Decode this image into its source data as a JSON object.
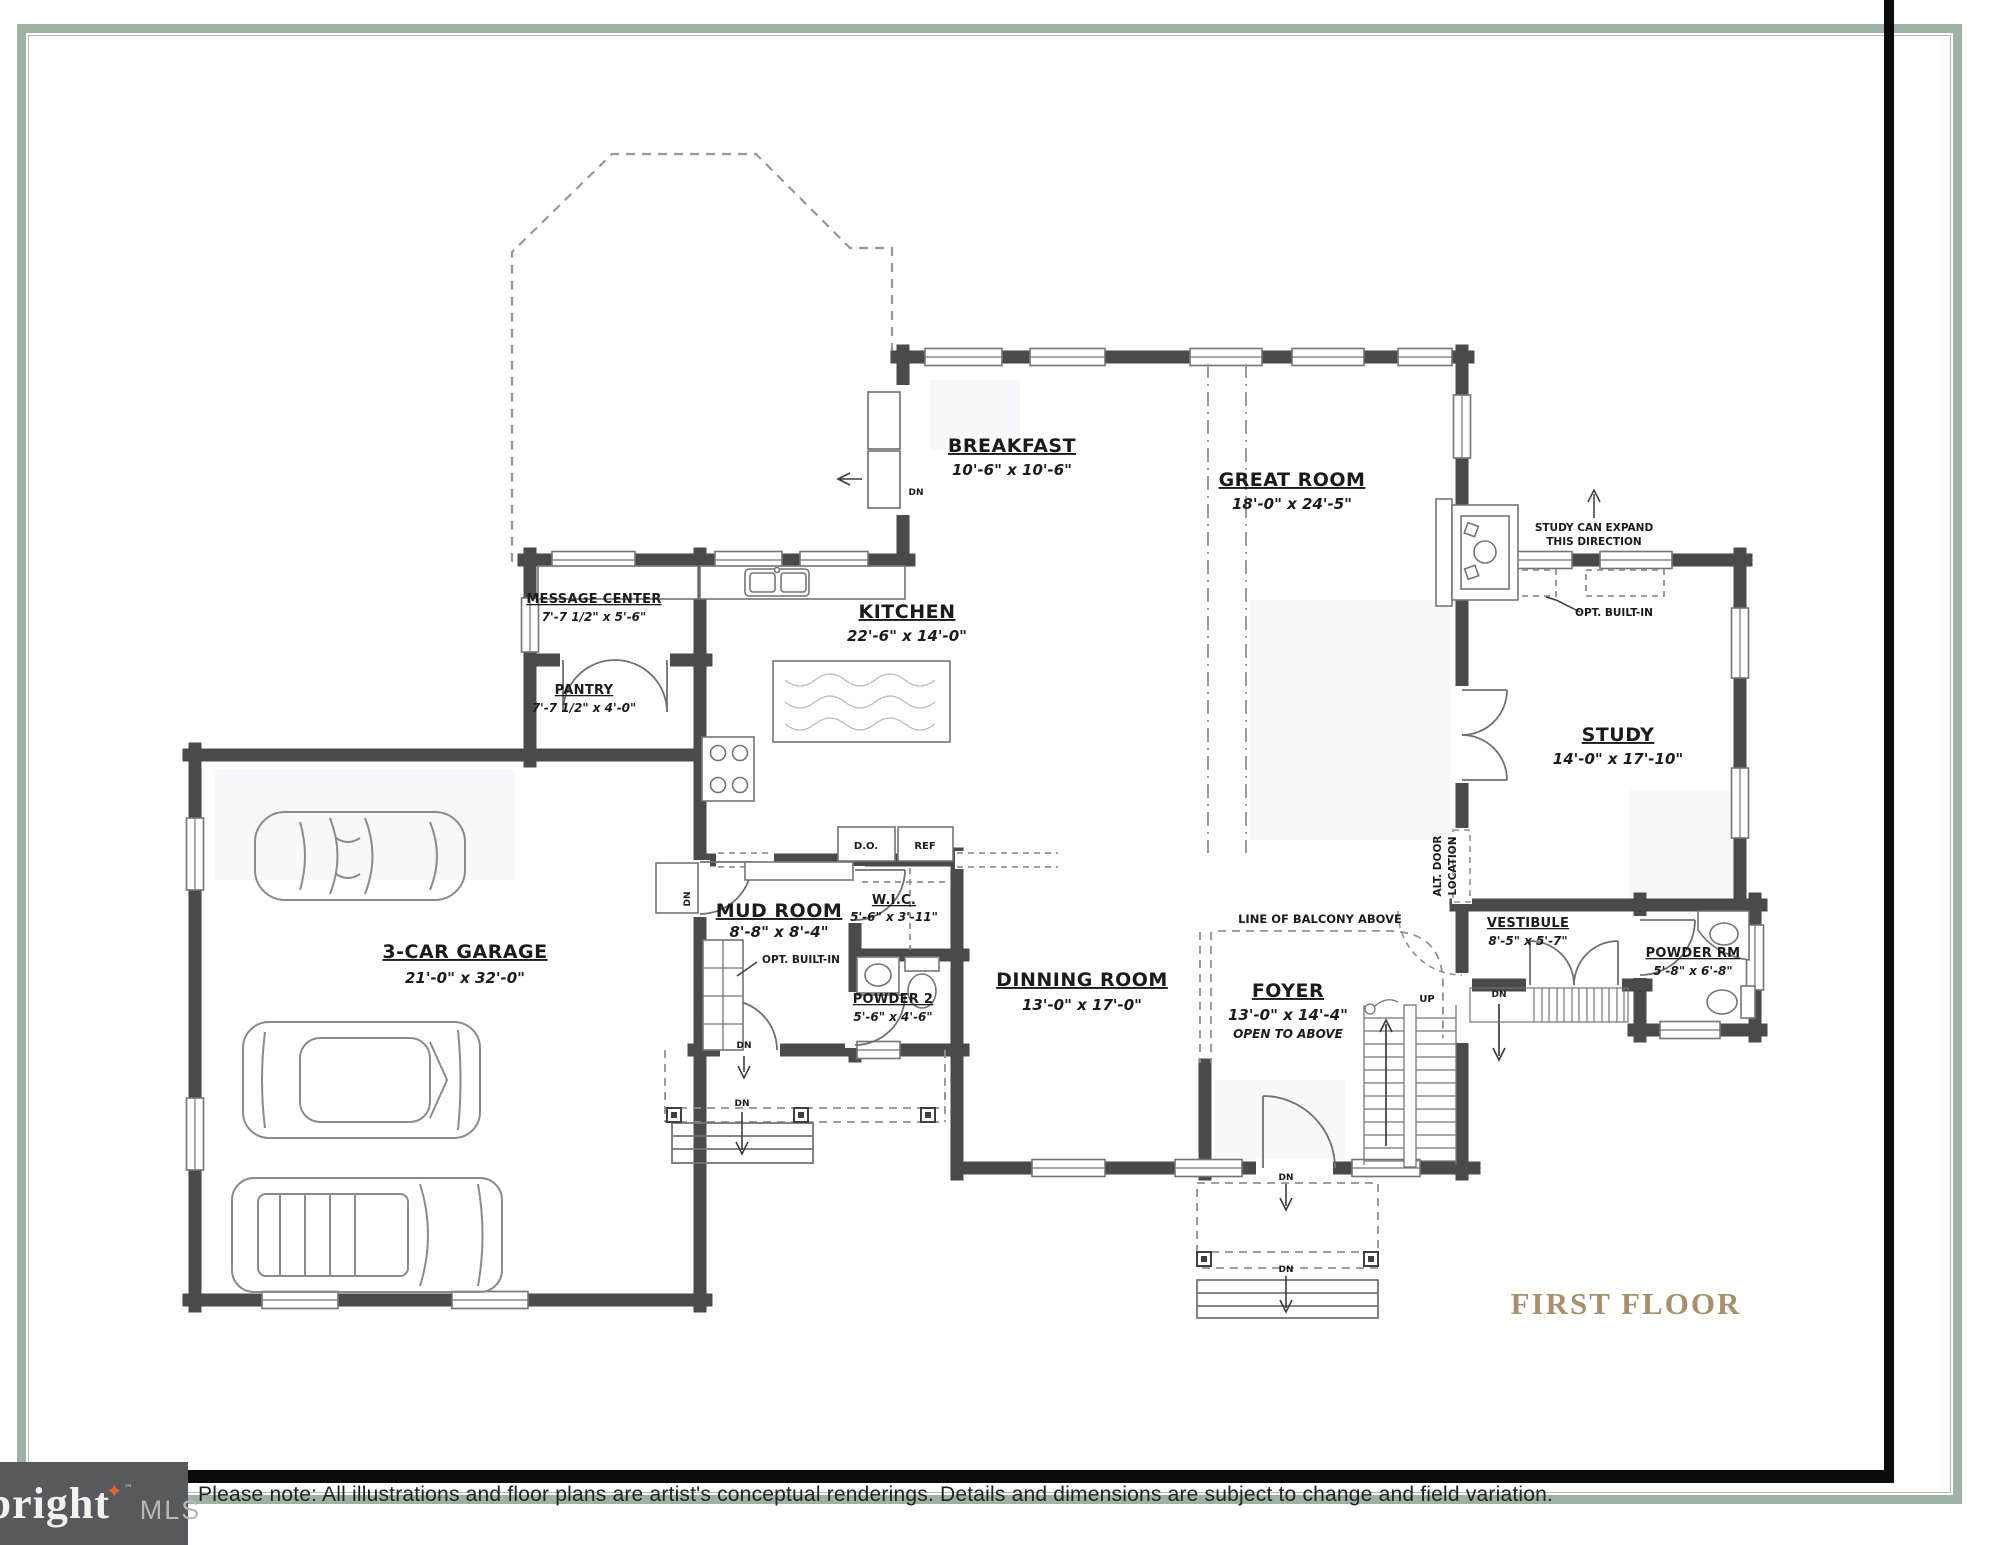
{
  "page": {
    "title": "FIRST FLOOR"
  },
  "palette": {
    "frame_green": "#9fb1a3",
    "frame_black": "#0b0b0b",
    "title_gold": "#a8906f",
    "wall_color": "#494a4c",
    "logo_bg": "#58595c",
    "logo_star_orange": "#e0653c",
    "logo_text": "#f2f1ef",
    "logo_mls_gray": "#b5b7ba"
  },
  "footer": {
    "disclaimer": "Please note: All illustrations and floor plans are artist's conceptual renderings. Details and dimensions are subject to change and field variation.",
    "logo": {
      "brand": "bright",
      "star": "✦",
      "tm": "™",
      "suffix": "MLS"
    }
  },
  "plan": {
    "rooms": [
      {
        "id": "breakfast",
        "name": "BREAKFAST",
        "dims": "10'-6\" x 10'-6\""
      },
      {
        "id": "great-room",
        "name": "GREAT ROOM",
        "dims": "18'-0\" x 24'-5\""
      },
      {
        "id": "kitchen",
        "name": "KITCHEN",
        "dims": "22'-6\" x 14'-0\""
      },
      {
        "id": "message-center",
        "name": "MESSAGE CENTER",
        "dims": "7'-7 1/2\" x 5'-6\""
      },
      {
        "id": "pantry",
        "name": "PANTRY",
        "dims": "7'-7 1/2\" x 4'-0\""
      },
      {
        "id": "garage",
        "name": "3-CAR GARAGE",
        "dims": "21'-0\" x 32'-0\""
      },
      {
        "id": "mud-room",
        "name": "MUD ROOM",
        "dims": "8'-8\" x 8'-4\""
      },
      {
        "id": "wic",
        "name": "W.I.C.",
        "dims": "5'-6\" x 3'-11\""
      },
      {
        "id": "powder-2",
        "name": "POWDER 2",
        "dims": "5'-6\" x 4'-6\""
      },
      {
        "id": "dining-room",
        "name": "DINNING ROOM",
        "dims": "13'-0\" x 17'-0\""
      },
      {
        "id": "foyer",
        "name": "FOYER",
        "dims": "13'-0\" x 14'-4\"",
        "note": "OPEN TO ABOVE"
      },
      {
        "id": "study",
        "name": "STUDY",
        "dims": "14'-0\" x 17'-10\""
      },
      {
        "id": "vestibule",
        "name": "VESTIBULE",
        "dims": "8'-5\" x 5'-7\""
      },
      {
        "id": "powder-rm",
        "name": "POWDER RM",
        "dims": "5'-8\" x 6'-8\""
      }
    ],
    "annotations": {
      "study_expand_1": "STUDY CAN EXPAND",
      "study_expand_2": "THIS DIRECTION",
      "opt_built_in": "OPT. BUILT-IN",
      "alt_door_1": "ALT. DOOR",
      "alt_door_2": "LOCATION",
      "balcony": "LINE OF BALCONY ABOVE"
    },
    "appliances": {
      "double_oven": "D.O.",
      "refrigerator": "REF"
    },
    "markers": {
      "up": "UP",
      "down": "DN"
    }
  }
}
